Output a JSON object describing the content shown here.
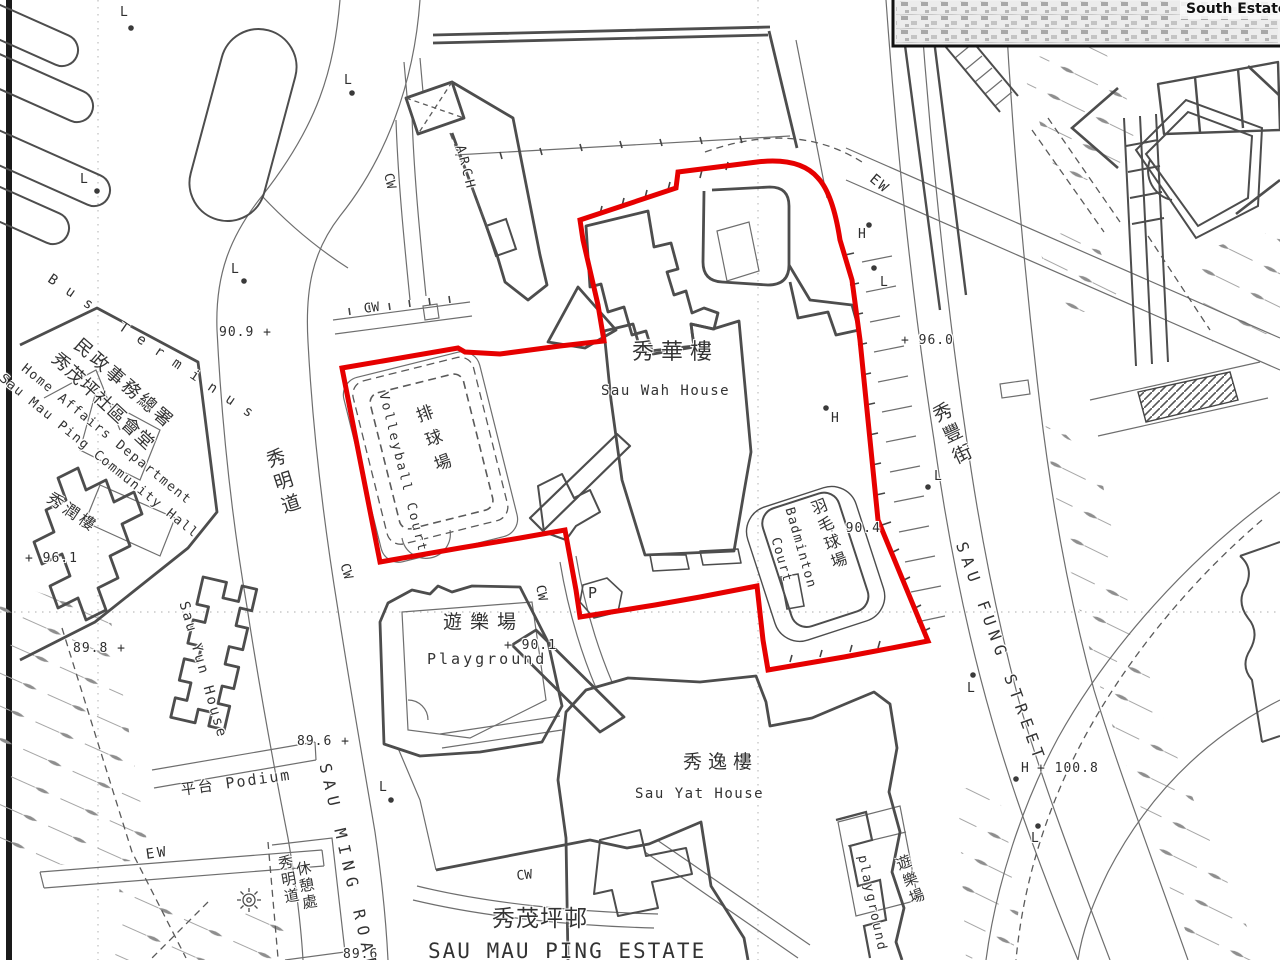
{
  "map": {
    "inset_label": "South Estate",
    "estate": {
      "cn": "秀茂坪邨",
      "en": "SAU MAU PING ESTATE"
    },
    "roads": {
      "sau_ming_cn": "秀明道",
      "sau_ming_en": "SAU MING ROAD",
      "sau_fung_cn": "秀豐街",
      "sau_fung_en": "SAU FUNG STREET"
    },
    "places": {
      "bus_terminus": "Bus Terminus",
      "community_hall_cn1": "民政事務總署",
      "community_hall_cn2": "秀茂坪社區會堂",
      "community_hall_en1": "Home Affairs Department",
      "community_hall_en2": "Sau Mau Ping Community Hall",
      "sau_yun_cn": "秀潤樓",
      "sau_yun_en": "Sau Yun House",
      "podium": "平台 Podium",
      "rest_garden_cn1": "秀明道",
      "rest_garden_cn2": "休憩處",
      "sau_wah_cn": "秀華樓",
      "sau_wah_en": "Sau Wah House",
      "volleyball_cn": "排球場",
      "volleyball_en": "Volleyball Court",
      "badminton_cn": "羽毛球場",
      "badminton_en1": "Badminton",
      "badminton_en2": "Court",
      "playground_w_cn": "遊樂場",
      "playground_w_en": "Playground",
      "playground_e_cn": "遊樂場",
      "playground_e_en": "playground",
      "sau_yat_cn": "秀逸樓",
      "sau_yat_en": "Sau Yat House"
    },
    "symbols": {
      "cw": "CW",
      "ew": "EW",
      "arch": "ARCH",
      "parking": "P",
      "lamp": "L",
      "hydrant": "H"
    },
    "spot_heights": {
      "h909": "90.9 +",
      "h961": "+ 96.1",
      "h898": "89.8 +",
      "h896a": "89.6 +",
      "h896b": "89.6",
      "h901": "+ 90.1",
      "h904": "+ 90.4",
      "h960": "+ 96.0",
      "h1008": "+ 100.8"
    },
    "colors": {
      "boundary": "#e60000",
      "linework": "#4d4d4d"
    }
  }
}
